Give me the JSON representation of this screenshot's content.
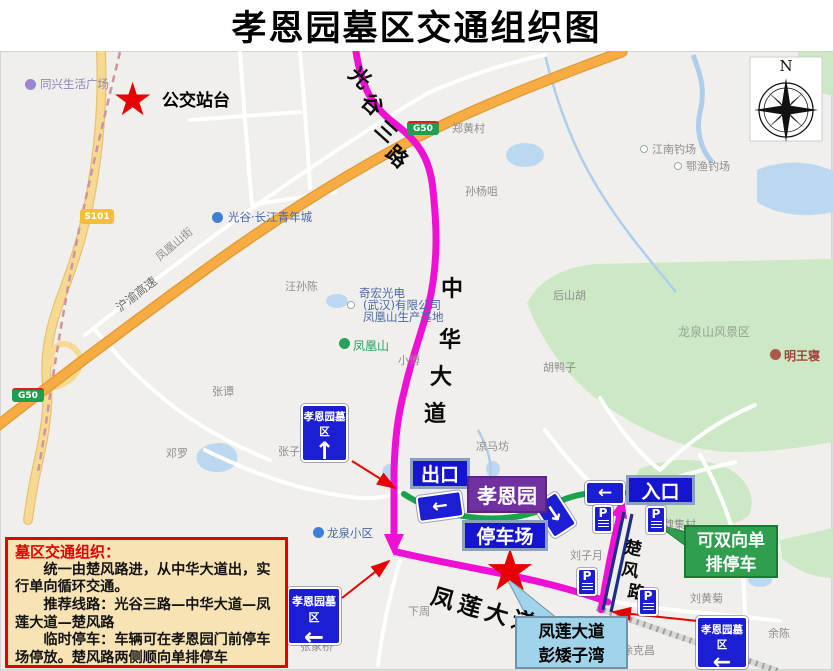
{
  "title": "孝恩园墓区交通组织图",
  "compass": {
    "north": "N"
  },
  "markers": {
    "star": "★"
  },
  "bus_stop": {
    "label": "公交站台"
  },
  "badges": {
    "g50": "G50",
    "s101": "S101"
  },
  "road_labels": {
    "huyu_expressway": "沪渝高速",
    "fenghuangshan_street": "凤凰山街",
    "guanggu3": [
      "光",
      "谷",
      "三",
      "路"
    ],
    "zhonghua": [
      "中",
      "华",
      "大",
      "道"
    ],
    "fenglian": "凤莲大道",
    "chufeng": [
      "楚",
      "风",
      "路"
    ]
  },
  "pois": {
    "tongxing": "同兴生活广场",
    "guanggu_youth": "光谷·长江青年城",
    "zhenghuangcun": "郑黄村",
    "sunyangju": "孙杨咀",
    "jiangnan_fishing": "江南钓场",
    "eyu_fishing": "鄂渔钓场",
    "wangsunchen": "汪孙陈",
    "qihong_1": "奇宏光电",
    "qihong_2": "(武汉)有限公司",
    "qihong_3": "凤凰山生产基地",
    "fenghuangshan": "凤凰山",
    "houshanhu": "后山胡",
    "longquan_scenic": "龙泉山风景区",
    "mingwangqin": "明王寝",
    "huyazi": "胡鸭子",
    "xiaofu": "小傅",
    "zhangtan": "张谭",
    "dengluo": "邓罗",
    "zhangzi": "张子",
    "liangmafang": "凉马坊",
    "longquan_xiaoqu": "龙泉小区",
    "liuziyue": "刘子月",
    "weijicun": "魏集村",
    "liuhuangju": "刘黄菊",
    "yuchen": "余陈",
    "xukechang": "徐克昌",
    "zhangjiaqiao": "张家桥",
    "xiazhou": "下周"
  },
  "signs": {
    "cemetery": "孝恩园墓区",
    "exit": "出口",
    "entrance": "入口",
    "parking_lot": "停车场",
    "xiaoenyuan": "孝恩园",
    "parking_p": "P",
    "up_arrow": "↑",
    "left_arrow": "←",
    "down_arrow": "↓"
  },
  "callouts": {
    "green_line1": "可双向单",
    "green_line2": "排停车",
    "blue_line1": "凤莲大道",
    "blue_line2": "彭矮子湾"
  },
  "info_box": {
    "heading": "墓区交通组织：",
    "p1": "统一由楚风路进，从中华大道出，实行单向循环交通。",
    "p2": "推荐线路：光谷三路—中华大道—凤莲大道—楚风路",
    "p3": "临时停车：车辆可在孝恩园门前停车场停放。楚风路两侧顺向单排停车"
  },
  "colors": {
    "route_pink": "#ee10d5",
    "route_green": "#1aa24e",
    "sign_blue": "#1b1ed2",
    "purple_box": "#7030a0",
    "green_box": "#2f9e4f",
    "callout_blue": "#9fd4ea",
    "highway_orange": "#f6ab43",
    "info_bg": "#f8e3b4",
    "annotation_red": "#e80000"
  }
}
